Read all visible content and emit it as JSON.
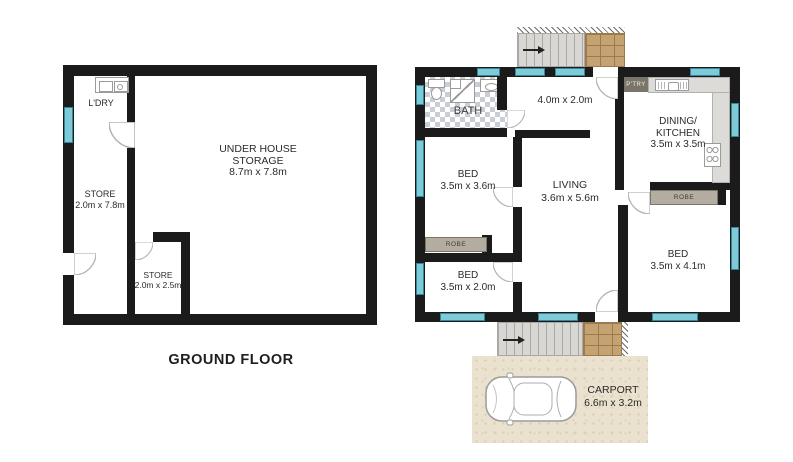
{
  "ground_floor": {
    "title": "GROUND FLOOR",
    "rooms": {
      "ldry": {
        "name": "L'DRY"
      },
      "store1": {
        "name": "STORE",
        "dims": "2.0m x 7.8m"
      },
      "storage": {
        "line1": "UNDER HOUSE",
        "line2": "STORAGE",
        "dims": "8.7m x 7.8m"
      },
      "store2": {
        "name": "STORE",
        "dims": "2.0m x 2.5m"
      }
    }
  },
  "upper_floor": {
    "rooms": {
      "bath": {
        "name": "BATH"
      },
      "hall": {
        "dims": "4.0m x 2.0m"
      },
      "pantry": {
        "name": "P'TRY"
      },
      "kitchen": {
        "line1": "DINING/",
        "line2": "KITCHEN",
        "dims": "3.5m x 3.5m"
      },
      "bed1": {
        "name": "BED",
        "dims": "3.5m x 3.6m"
      },
      "living": {
        "name": "LIVING",
        "dims": "3.6m x 5.6m"
      },
      "robe1": {
        "name": "ROBE"
      },
      "robe2": {
        "name": "ROBE"
      },
      "bed2": {
        "name": "BED",
        "dims": "3.5m x 2.0m"
      },
      "bed3": {
        "name": "BED",
        "dims": "3.5m x 4.1m"
      }
    }
  },
  "carport": {
    "name": "CARPORT",
    "dims": "6.6m x 3.2m"
  },
  "colors": {
    "wall": "#1b1b1b",
    "window_fill": "#7ecbd7",
    "window_border": "#35869a",
    "robe_fill": "#b3aca0",
    "pantry_fill": "#7a7569",
    "counter_fill": "#dcdbd7",
    "bath_tile": "#c9cdd5",
    "stair_fill": "#d8d7d3",
    "brick_fill": "#c5a271",
    "carport_fill": "#eae2cf",
    "door_arc": "#b4b4b4"
  }
}
